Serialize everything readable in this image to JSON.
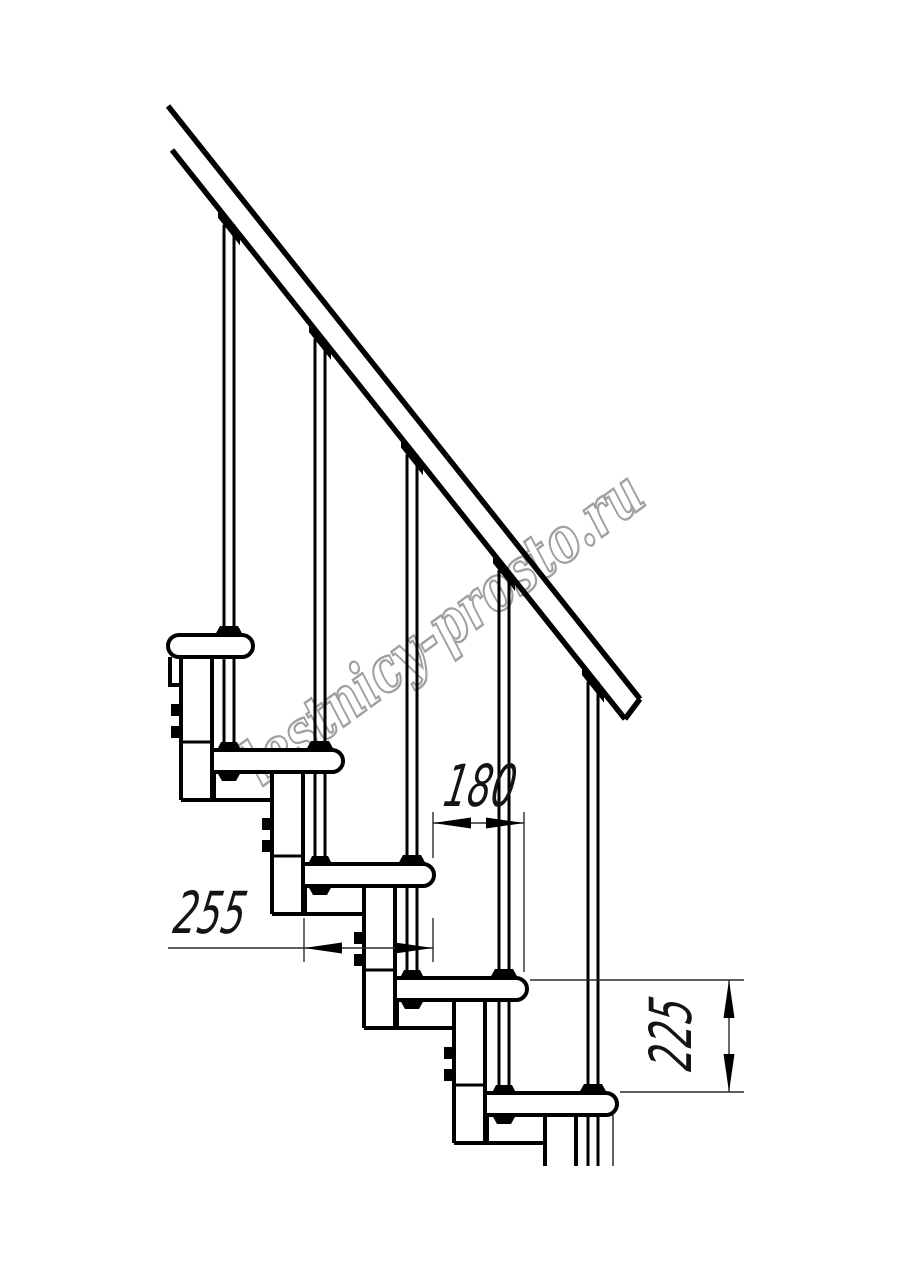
{
  "page": {
    "background": "#ffffff"
  },
  "watermark": {
    "text": "lestnicy-prosto.ru",
    "outline_color": "#a0a0a0",
    "fill_color": "#ffffff",
    "rotation_deg": -36.3,
    "center": [
      455,
      645
    ],
    "font_size": 62,
    "text_length": 480
  },
  "drawing": {
    "line_color": "#000000",
    "thin_line_color": "#2a2a2a",
    "canvas": {
      "width": 914,
      "height": 1280
    },
    "handrail": {
      "upper": [
        [
          168,
          106
        ],
        [
          640,
          699
        ]
      ],
      "lower": [
        [
          172,
          150
        ],
        [
          625,
          719
        ]
      ],
      "stroke": 5.5
    },
    "treads": {
      "tops": [
        635,
        750,
        864,
        978,
        1093
      ],
      "lefts": [
        168,
        212,
        303,
        395,
        485,
        576
      ],
      "rights": [
        253,
        343,
        434,
        527,
        617
      ],
      "height": 22,
      "nose_radius": 11,
      "stroke": 4
    },
    "balusters": {
      "centers": [
        229,
        320,
        412,
        504,
        593
      ],
      "half_gap": 5,
      "stroke": 3
    },
    "modules": {
      "box_height": 28,
      "column_width": 31,
      "joint_offset_above_tread": 8,
      "content_bottom": 1166
    },
    "extra_lines": [
      [
        613,
        1115,
        613,
        1166
      ]
    ],
    "dims": [
      {
        "label": "180",
        "orientation": "horizontal",
        "line": [
          433,
          823,
          524,
          823
        ],
        "arrow_span": [
          433,
          524
        ],
        "ext": [
          [
            433,
            812,
            433,
            858
          ],
          [
            524,
            812,
            524,
            972
          ]
        ],
        "text_pos": [
          477,
          806
        ],
        "text_rotate": 0
      },
      {
        "label": "255",
        "orientation": "horizontal",
        "line": [
          168,
          948,
          433,
          948
        ],
        "arrow_span": [
          304,
          433
        ],
        "ext": [
          [
            304,
            918,
            304,
            962
          ],
          [
            433,
            918,
            433,
            962
          ]
        ],
        "text_pos": [
          207,
          933
        ],
        "text_rotate": 0
      },
      {
        "label": "225",
        "orientation": "vertical",
        "line": [
          729,
          980,
          729,
          1092
        ],
        "arrow_span": [
          980,
          1092
        ],
        "ext": [
          [
            530,
            980,
            744,
            980
          ],
          [
            620,
            1092,
            744,
            1092
          ]
        ],
        "text_pos": [
          691,
          1037
        ],
        "text_rotate": -90
      }
    ]
  }
}
